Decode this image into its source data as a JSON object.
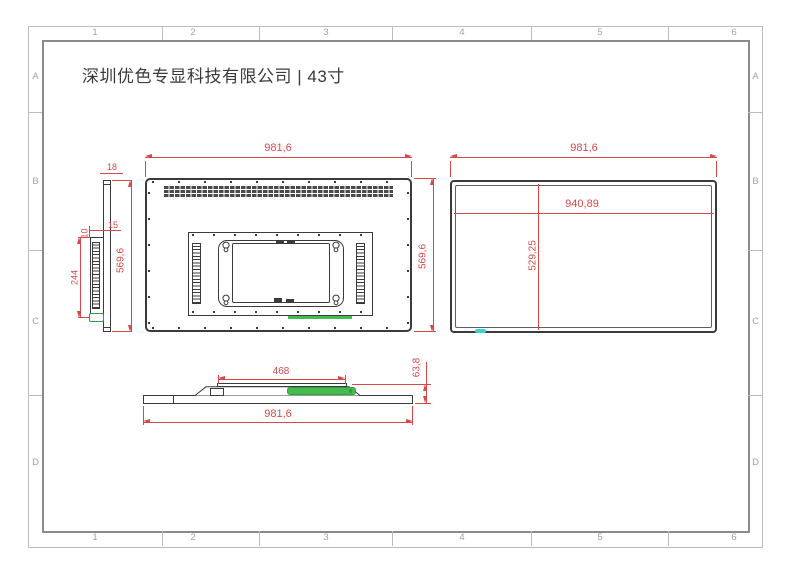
{
  "title": "深圳优色专显科技有限公司 | 43寸",
  "grid": {
    "cols": [
      "1",
      "2",
      "3",
      "4",
      "5",
      "6"
    ],
    "rows": [
      "A",
      "B",
      "C",
      "D"
    ]
  },
  "dims": {
    "side_thickness": "18",
    "side_height": "569,6",
    "side_bracket_height": "244",
    "side_inset": "15",
    "side_gap": "10",
    "rear_width": "981,6",
    "rear_height": "569,6",
    "front_width": "981,6",
    "front_display_width": "940,89",
    "front_display_height": "529,25",
    "bottom_bracket_width": "468",
    "bottom_width": "981,6",
    "bottom_depth": "63,8"
  },
  "colors": {
    "red": "#d84848",
    "ink": "#3b3b3b",
    "green": "#2f9e44",
    "green-fill": "#45bd4e",
    "cyan": "#3fd2cc",
    "frame": "#bcbcbc",
    "frame-dark": "#8a8a8a",
    "label": "#a3a3a3",
    "title": "#3a3a3a"
  }
}
